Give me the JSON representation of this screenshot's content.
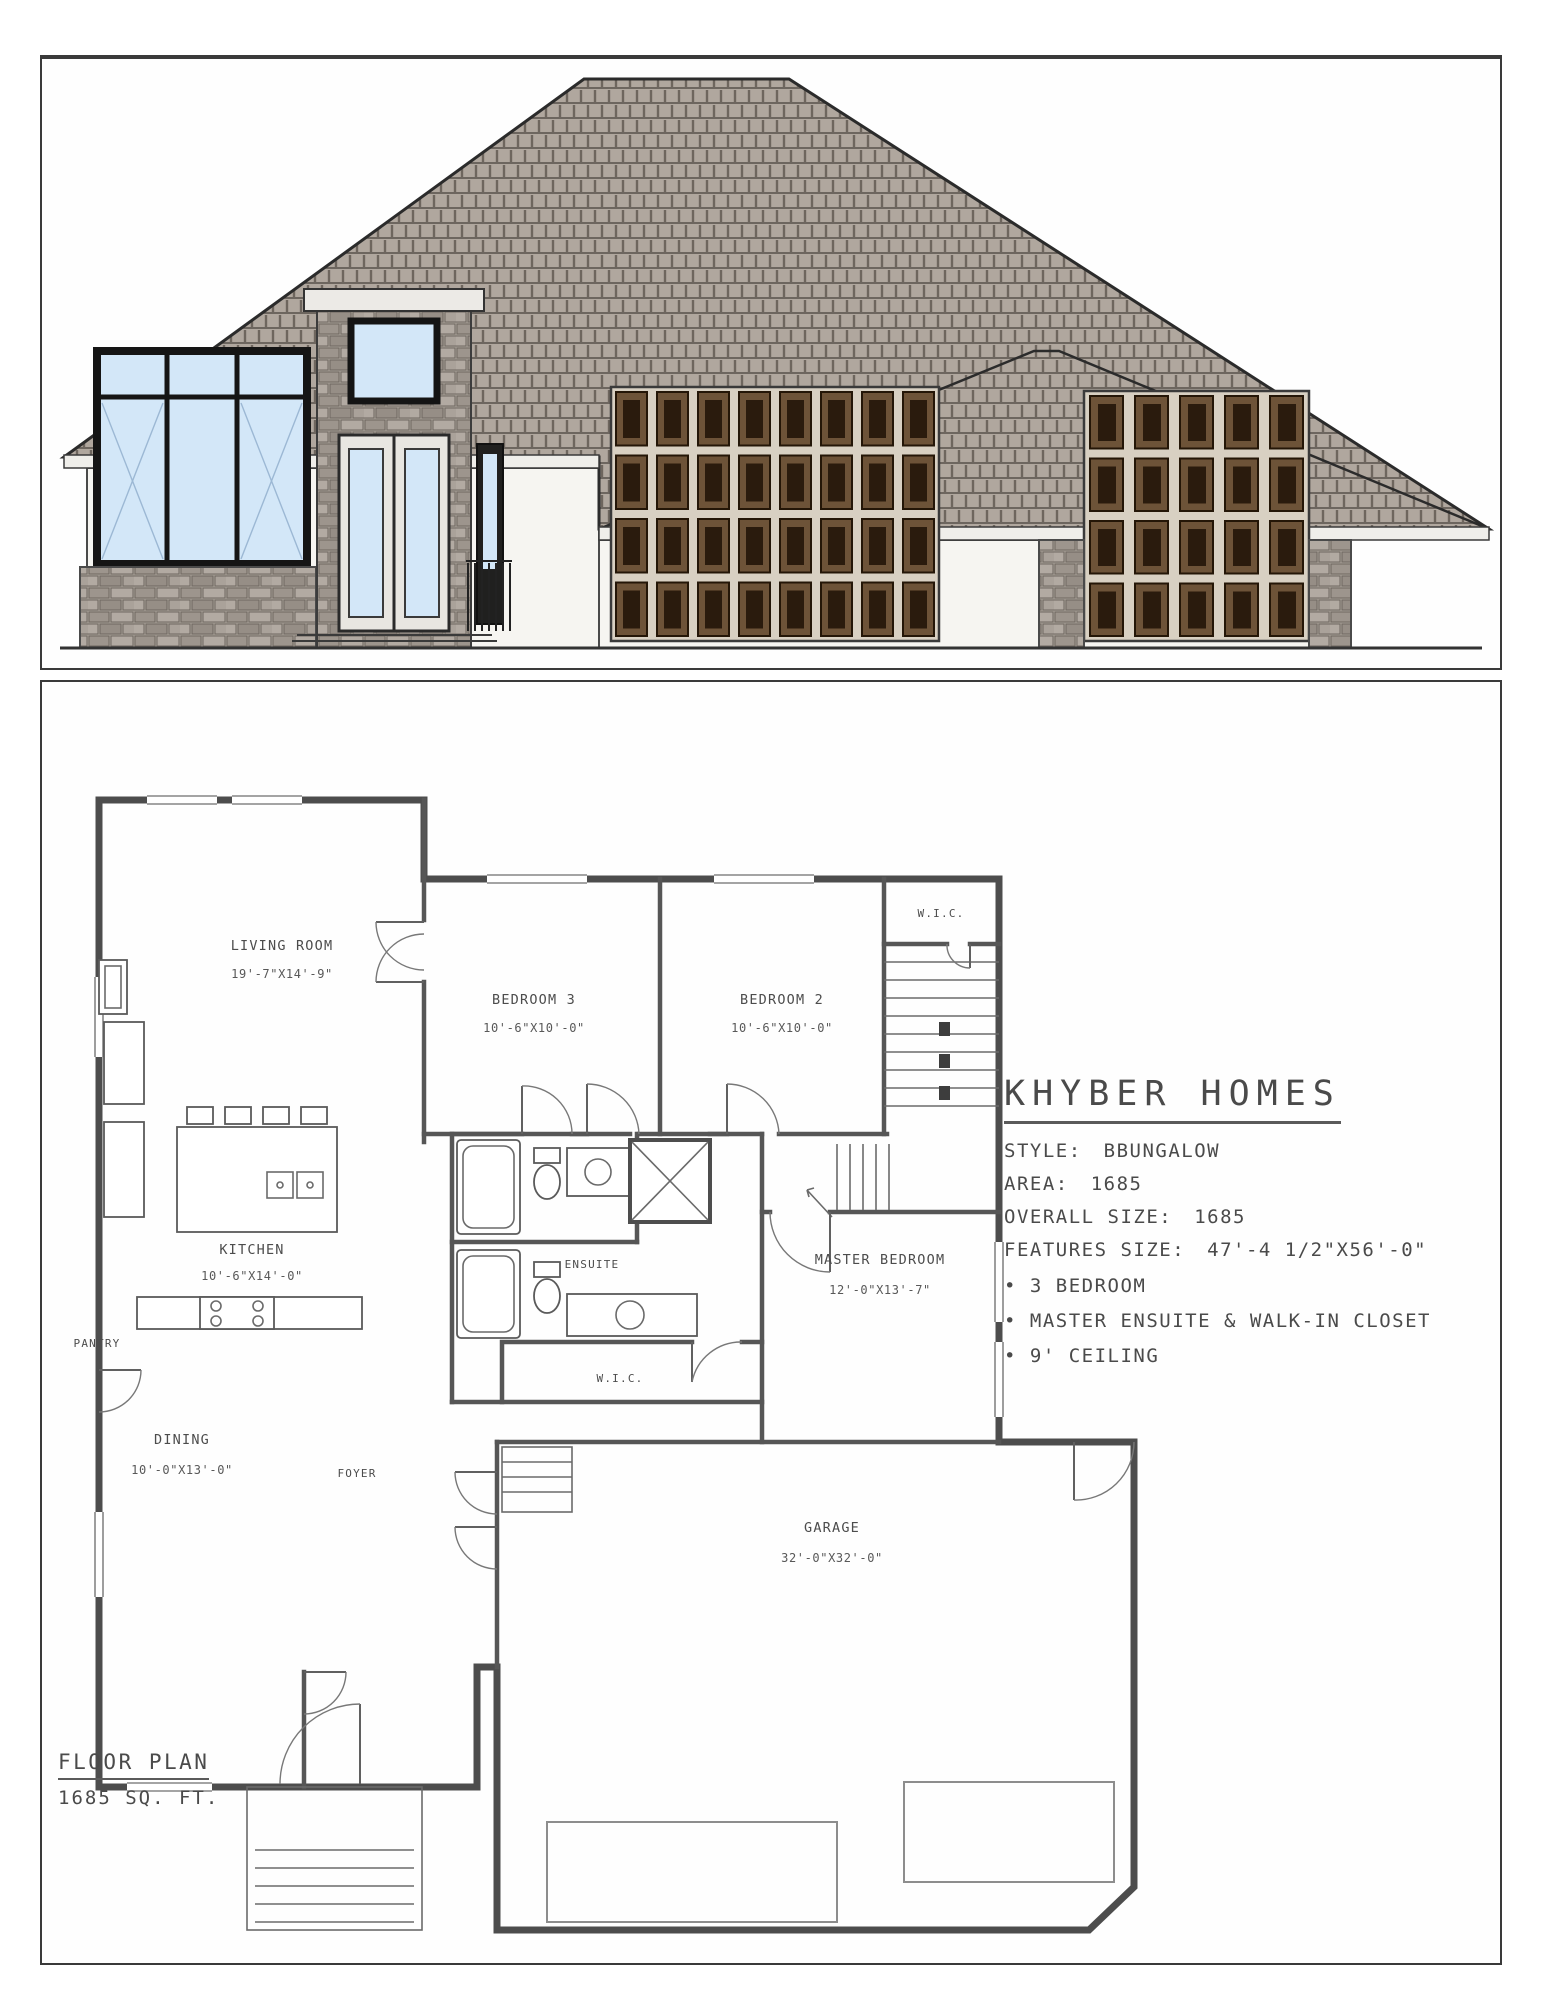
{
  "title_block": {
    "company": "KHYBER HOMES",
    "specs": [
      {
        "label": "STYLE:",
        "value": "BBUNGALOW"
      },
      {
        "label": "AREA:",
        "value": "1685"
      },
      {
        "label": "OVERALL SIZE:",
        "value": "1685"
      },
      {
        "label": "FEATURES SIZE:",
        "value": "47'-4 1/2\"X56'-0\""
      }
    ],
    "bullets": [
      "3 BEDROOM",
      "MASTER ENSUITE & WALK-IN CLOSET",
      "9' CEILING"
    ]
  },
  "plan_label": {
    "title": "FLOOR PLAN",
    "area": "1685 SQ. FT."
  },
  "rooms": {
    "living": {
      "name": "LIVING ROOM",
      "dim": "19'-7\"X14'-9\""
    },
    "bedroom3": {
      "name": "BEDROOM 3",
      "dim": "10'-6\"X10'-0\""
    },
    "bedroom2": {
      "name": "BEDROOM 2",
      "dim": "10'-6\"X10'-0\""
    },
    "wic_top": {
      "name": "W.I.C."
    },
    "kitchen": {
      "name": "KITCHEN",
      "dim": "10'-6\"X14'-0\""
    },
    "pantry": {
      "name": "PANTRY"
    },
    "ensuite": {
      "name": "ENSUITE"
    },
    "master": {
      "name": "MASTER BEDROOM",
      "dim": "12'-0\"X13'-7\""
    },
    "wic_master": {
      "name": "W.I.C."
    },
    "dining": {
      "name": "DINING",
      "dim": "10'-0\"X13'-0\""
    },
    "foyer": {
      "name": "FOYER"
    },
    "garage": {
      "name": "GARAGE",
      "dim": "32'-0\"X32'-0\""
    }
  },
  "colors": {
    "line": "#3f3f3f",
    "roof": "#b0a79e",
    "glass": "#d3e7f8",
    "stone": "#a8a098",
    "garage_panel_dark": "#2a1b0d",
    "garage_panel_mid": "#6d5338",
    "garage_door_frame": "#d8d0c2",
    "wall_fill": "#f6f5f1"
  }
}
